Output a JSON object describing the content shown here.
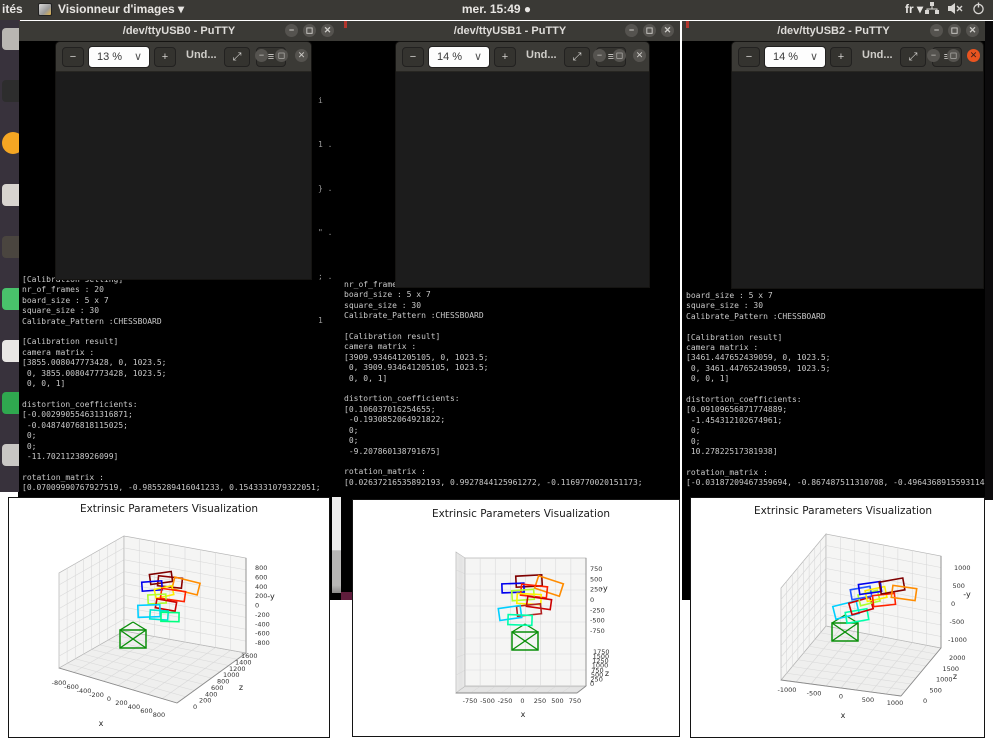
{
  "topbar": {
    "left_trunc": "ités",
    "app_name": "Visionneur d'images",
    "app_caret": "▾",
    "clock": "mer. 15:49 ●",
    "lang": "fr",
    "lang_caret": "▾"
  },
  "icons": {
    "minimize": "−",
    "maximize": "◻",
    "close": "✕",
    "zoom_out": "−",
    "zoom_in": "+",
    "chevron_down": "∨",
    "expand": "⤢",
    "menu": "≡"
  },
  "dock": {
    "items": [
      {
        "name": "printer",
        "color": "#b9b6b2"
      },
      {
        "name": "display",
        "color": "#2d2d2d"
      },
      {
        "name": "firefox",
        "color": "#f5a623"
      },
      {
        "name": "gimp",
        "color": "#d8d4cf"
      },
      {
        "name": "tweaks",
        "color": "#4a453f"
      },
      {
        "name": "updater",
        "color": "#49c26b"
      },
      {
        "name": "claw-app",
        "color": "#e9e7e4"
      },
      {
        "name": "package",
        "color": "#2fa84f"
      },
      {
        "name": "trash",
        "color": "#c9c7c4"
      }
    ]
  },
  "windows": [
    {
      "title": "/dev/ttyUSB0 - PuTTY",
      "viewer": {
        "zoom": "13 %",
        "title": "Und..."
      },
      "terminal_lines": [
        "[Calibration setting]",
        "nr_of_frames : 20",
        "board_size : 5 x 7",
        "square_size : 30",
        "Calibrate_Pattern :CHESSBOARD",
        "",
        "[Calibration result]",
        "camera matrix :",
        "[3855.008047773428, 0, 1023.5;",
        " 0, 3855.008047773428, 1023.5;",
        " 0, 0, 1]",
        "",
        "distortion_coefficients:",
        "[-0.002990554631316871;",
        " -0.04874076818115025;",
        " 0;",
        " 0;",
        " -11.70211238926099]",
        "",
        "rotation_matrix :",
        "[0.07009990767927519, -0.9855289416041233, 0.1543331079322051;"
      ],
      "fragments": [
        "i",
        "1 .",
        "} .",
        "\" .",
        "; .",
        "1"
      ]
    },
    {
      "title": "/dev/ttyUSB1 - PuTTY",
      "viewer": {
        "zoom": "14 %",
        "title": "Und..."
      },
      "terminal_lines": [
        "nr_of_frames : 20",
        "board_size : 5 x 7",
        "square_size : 30",
        "Calibrate_Pattern :CHESSBOARD",
        "",
        "[Calibration result]",
        "camera matrix :",
        "[3909.934641205105, 0, 1023.5;",
        " 0, 3909.934641205105, 1023.5;",
        " 0, 0, 1]",
        "",
        "distortion_coefficients:",
        "[0.106037016254655;",
        " -0.1930852064921822;",
        " 0;",
        " 0;",
        " -9.207860138791675]",
        "",
        "rotation_matrix :",
        "[0.02637216535892193, 0.9927844125961272, -0.1169770020151173;"
      ],
      "fragments": [
        "1 .",
        ") .",
        "} .",
        "; .",
        "1 ."
      ]
    },
    {
      "title": "/dev/ttyUSB2 - PuTTY",
      "viewer": {
        "zoom": "14 %",
        "title": "Und..."
      },
      "terminal_lines": [
        "board_size : 5 x 7",
        "square_size : 30",
        "Calibrate_Pattern :CHESSBOARD",
        "",
        "[Calibration result]",
        "camera matrix :",
        "[3461.447652439059, 0, 1023.5;",
        " 0, 3461.447652439059, 1023.5;",
        " 0, 0, 1]",
        "",
        "distortion_coefficients:",
        "[0.09109656871774889;",
        " -1.454312102674961;",
        " 0;",
        " 0;",
        " 10.27822517381938]",
        "",
        "rotation_matrix :",
        "[-0.03187209467359694, -0.867487511310708, -0.4964368915593114;"
      ],
      "fragments": [
        ": .",
        "- .",
        "; .",
        "= .",
        "1"
      ]
    }
  ],
  "chart_data": [
    {
      "type": "scatter",
      "title": "Extrinsic Parameters Visualization",
      "xlabel": "x",
      "zlabel": "z",
      "ylabel": "-y",
      "x_ticks": [
        -800,
        -600,
        -400,
        -200,
        0,
        200,
        400,
        600,
        800
      ],
      "z_ticks": [
        0,
        200,
        400,
        600,
        800,
        1000,
        1200,
        1400,
        1600
      ],
      "y_ticks": [
        -800,
        -600,
        -400,
        -200,
        0,
        200,
        400,
        600,
        800
      ],
      "grid": true,
      "legend": false,
      "camera_pose": {
        "x": 124,
        "y": 141
      },
      "boards": [
        {
          "color": "#7f0000",
          "x": 152,
          "y": 80,
          "w": 22,
          "h": 10,
          "r": -8
        },
        {
          "color": "#8b0000",
          "x": 161,
          "y": 84,
          "w": 24,
          "h": 10,
          "r": 6
        },
        {
          "color": "#ff8c00",
          "x": 177,
          "y": 88,
          "w": 26,
          "h": 12,
          "r": 14
        },
        {
          "color": "#0000ee",
          "x": 143,
          "y": 88,
          "w": 20,
          "h": 9,
          "r": -4
        },
        {
          "color": "#ffee00",
          "x": 155,
          "y": 94,
          "w": 18,
          "h": 9,
          "r": -12
        },
        {
          "color": "#ff2200",
          "x": 164,
          "y": 97,
          "w": 24,
          "h": 10,
          "r": 8
        },
        {
          "color": "#adff2f",
          "x": 148,
          "y": 101,
          "w": 18,
          "h": 9,
          "r": -3
        },
        {
          "color": "#cc0000",
          "x": 157,
          "y": 107,
          "w": 20,
          "h": 9,
          "r": 10
        },
        {
          "color": "#00cfff",
          "x": 140,
          "y": 113,
          "w": 22,
          "h": 12,
          "r": -2
        },
        {
          "color": "#00e5d0",
          "x": 150,
          "y": 117,
          "w": 18,
          "h": 9,
          "r": 4
        },
        {
          "color": "#00ff7f",
          "x": 161,
          "y": 119,
          "w": 18,
          "h": 9,
          "r": 1
        }
      ]
    },
    {
      "type": "scatter",
      "title": "Extrinsic Parameters Visualization",
      "xlabel": "x",
      "zlabel": "z",
      "ylabel": "-y",
      "x_ticks": [
        -750,
        -500,
        -250,
        0,
        250,
        500,
        750
      ],
      "z_ticks": [
        0,
        250,
        500,
        750,
        1000,
        1250,
        1500,
        1750
      ],
      "y_ticks": [
        -750,
        -500,
        -250,
        0,
        250,
        500,
        750
      ],
      "grid": true,
      "legend": false,
      "camera_pose": {
        "x": 172,
        "y": 141
      },
      "boards": [
        {
          "color": "#7f0000",
          "x": 176,
          "y": 81,
          "w": 26,
          "h": 11,
          "r": -3
        },
        {
          "color": "#ff8c00",
          "x": 196,
          "y": 86,
          "w": 26,
          "h": 13,
          "r": 18
        },
        {
          "color": "#0000ee",
          "x": 160,
          "y": 88,
          "w": 22,
          "h": 9,
          "r": -2
        },
        {
          "color": "#ff2200",
          "x": 181,
          "y": 91,
          "w": 26,
          "h": 11,
          "r": 6
        },
        {
          "color": "#adff2f",
          "x": 170,
          "y": 95,
          "w": 22,
          "h": 10,
          "r": -4
        },
        {
          "color": "#ffee00",
          "x": 176,
          "y": 99,
          "w": 24,
          "h": 10,
          "r": 3
        },
        {
          "color": "#cc0000",
          "x": 186,
          "y": 103,
          "w": 24,
          "h": 10,
          "r": 8
        },
        {
          "color": "#b22222",
          "x": 176,
          "y": 110,
          "w": 24,
          "h": 10,
          "r": -6
        },
        {
          "color": "#00cfff",
          "x": 157,
          "y": 113,
          "w": 22,
          "h": 12,
          "r": -8
        },
        {
          "color": "#00ffaa",
          "x": 167,
          "y": 120,
          "w": 24,
          "h": 10,
          "r": 2
        }
      ]
    },
    {
      "type": "scatter",
      "title": "Extrinsic Parameters Visualization",
      "xlabel": "x",
      "zlabel": "z",
      "ylabel": "-y",
      "x_ticks": [
        -1000,
        -500,
        0,
        500,
        1000
      ],
      "z_ticks": [
        0,
        500,
        1000,
        1500,
        2000
      ],
      "y_ticks": [
        -1000,
        -500,
        0,
        500,
        1000
      ],
      "grid": true,
      "legend": false,
      "camera_pose": {
        "x": 154,
        "y": 134
      },
      "boards": [
        {
          "color": "#00cfff",
          "x": 155,
          "y": 112,
          "w": 24,
          "h": 13,
          "r": -14
        },
        {
          "color": "#00ffaa",
          "x": 166,
          "y": 118,
          "w": 22,
          "h": 11,
          "r": -10
        },
        {
          "color": "#cc0000",
          "x": 170,
          "y": 108,
          "w": 22,
          "h": 12,
          "r": -16
        },
        {
          "color": "#adff2f",
          "x": 178,
          "y": 100,
          "w": 20,
          "h": 11,
          "r": -14
        },
        {
          "color": "#2255ff",
          "x": 170,
          "y": 95,
          "w": 20,
          "h": 10,
          "r": -10
        },
        {
          "color": "#ffee00",
          "x": 185,
          "y": 96,
          "w": 20,
          "h": 11,
          "r": -12
        },
        {
          "color": "#0000ee",
          "x": 179,
          "y": 90,
          "w": 22,
          "h": 10,
          "r": -8
        },
        {
          "color": "#ff2200",
          "x": 193,
          "y": 102,
          "w": 22,
          "h": 11,
          "r": -6
        },
        {
          "color": "#7f0000",
          "x": 201,
          "y": 88,
          "w": 24,
          "h": 12,
          "r": -10
        },
        {
          "color": "#ff8c00",
          "x": 213,
          "y": 95,
          "w": 24,
          "h": 12,
          "r": 8
        }
      ]
    }
  ]
}
